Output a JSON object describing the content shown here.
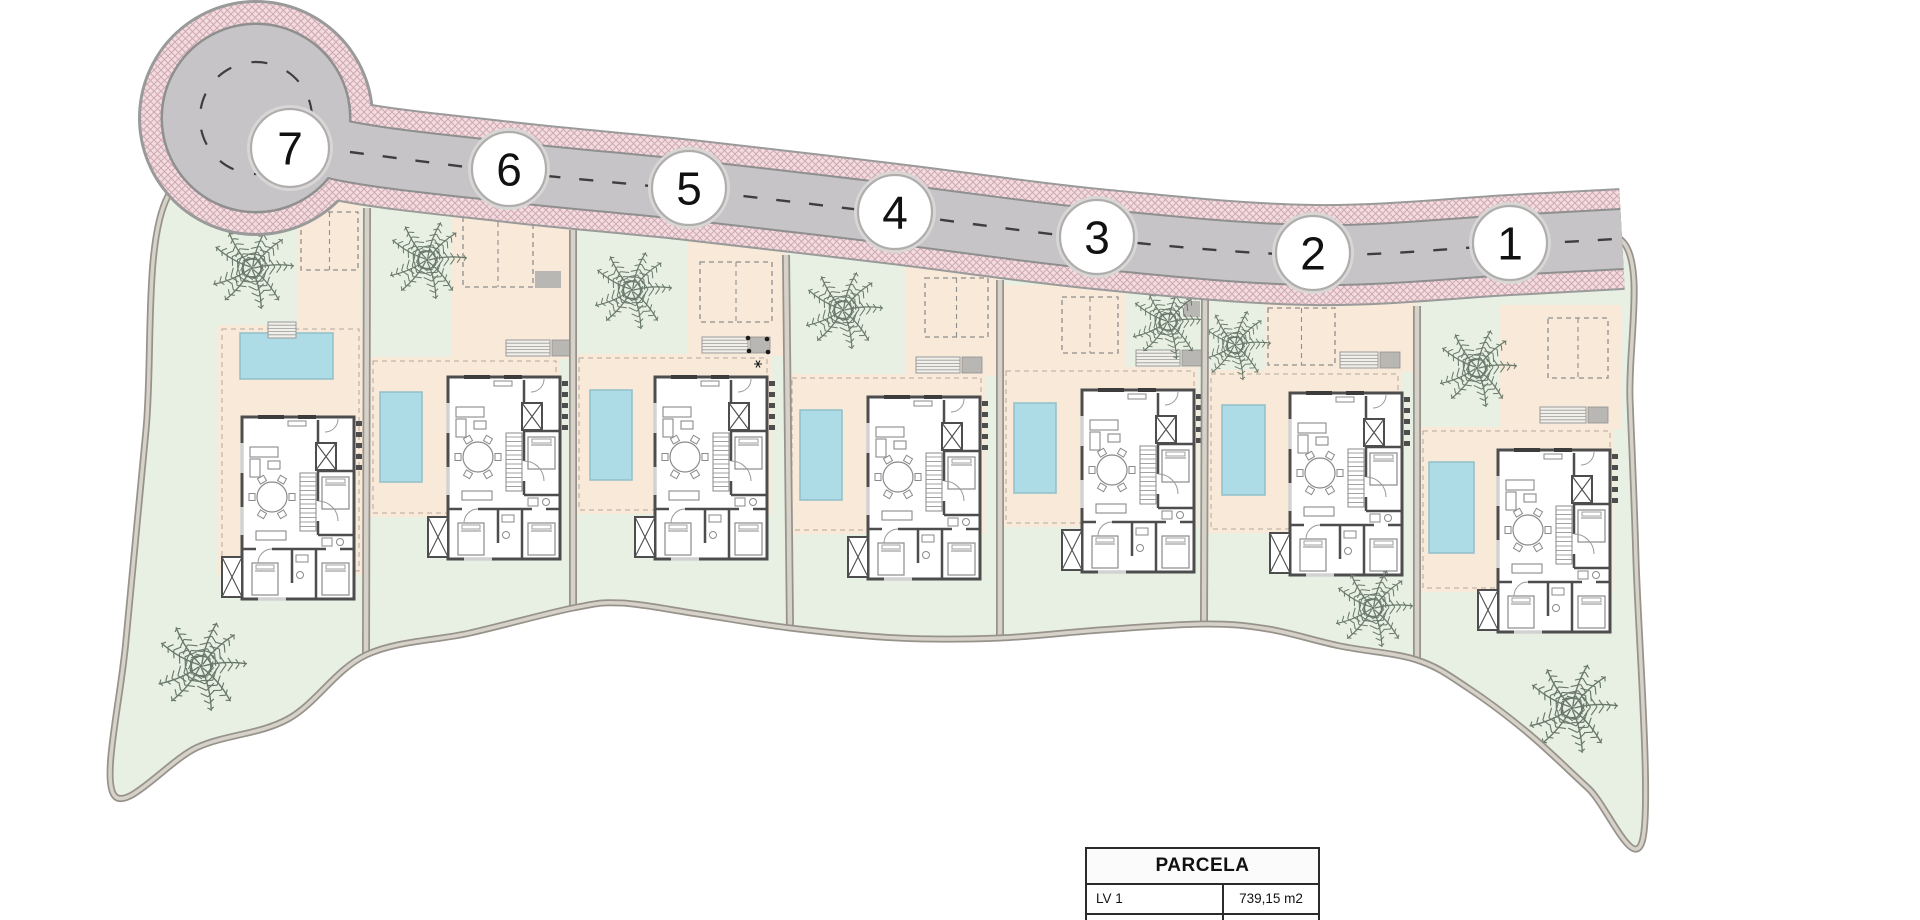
{
  "table": {
    "header": "PARCELA",
    "rows": [
      {
        "label": "LV 1",
        "value": "739,15 m2"
      }
    ]
  },
  "plan": {
    "colors": {
      "green": "#e7f0e2",
      "peach": "#f8e9d9",
      "pool": "#aedce6",
      "pool_edge": "#90bfca",
      "asphalt": "#c6c4c6",
      "road_edge": "#9a9a9a",
      "road_edge2": "#8f8f8f",
      "sidewalk_base": "#f2dce0",
      "sidewalk_line": "#d0a8b1",
      "wall_fill": "#d6d2c9",
      "wall_edge": "#97938b",
      "house_wall": "#4d4d4d",
      "furniture": "#8a8a8a",
      "window": "#d2d2d2",
      "step_fill": "#f1efe9",
      "kerb": "#b9b7b3",
      "center_dash": "#3e3e3e",
      "circle_stroke": "#b0adad",
      "number_text": "#111111",
      "palm": "#68786a",
      "terrace_dash": "#b3a89a",
      "parking_dash": "#8f8f8f"
    },
    "site": {
      "outline": [
        [
          168,
          196
        ],
        [
          290,
          158
        ],
        [
          509,
          176
        ],
        [
          689,
          194
        ],
        [
          895,
          218
        ],
        [
          1097,
          243
        ],
        [
          1313,
          259
        ],
        [
          1510,
          249
        ],
        [
          1624,
          243
        ],
        [
          1630,
          400
        ],
        [
          1636,
          560
        ],
        [
          1643,
          838
        ],
        [
          1588,
          788
        ],
        [
          1528,
          733
        ],
        [
          1468,
          688
        ],
        [
          1417,
          660
        ],
        [
          1340,
          646
        ],
        [
          1268,
          629
        ],
        [
          1204,
          624
        ],
        [
          1100,
          630
        ],
        [
          1000,
          638
        ],
        [
          898,
          638
        ],
        [
          790,
          628
        ],
        [
          698,
          614
        ],
        [
          622,
          603
        ],
        [
          573,
          608
        ],
        [
          470,
          633
        ],
        [
          366,
          655
        ],
        [
          288,
          719
        ],
        [
          198,
          747
        ],
        [
          114,
          795
        ],
        [
          126,
          640
        ],
        [
          146,
          430
        ]
      ]
    },
    "road": {
      "centerline": [
        [
          256,
          118
        ],
        [
          340,
          150
        ],
        [
          509,
          172
        ],
        [
          689,
          190
        ],
        [
          895,
          214
        ],
        [
          1097,
          239
        ],
        [
          1313,
          255
        ],
        [
          1510,
          245
        ],
        [
          1622,
          239
        ]
      ],
      "dashline": [
        [
          350,
          152
        ],
        [
          509,
          172
        ],
        [
          689,
          190
        ],
        [
          895,
          214
        ],
        [
          1097,
          239
        ],
        [
          1313,
          255
        ],
        [
          1510,
          245
        ],
        [
          1615,
          239
        ]
      ],
      "widths": {
        "edge": 102,
        "pink": 98,
        "edge2": 62,
        "asphalt": 58
      },
      "bulb": {
        "cx": 256,
        "cy": 118,
        "r_edge": 118,
        "r_pink": 115,
        "r_edge2": 95.5,
        "r_asphalt": 93,
        "r_dash": 56
      }
    },
    "walls": [
      [
        367,
        208,
        366,
        655
      ],
      [
        573,
        230,
        573,
        608
      ],
      [
        786,
        255,
        790,
        628
      ],
      [
        1000,
        280,
        1000,
        638
      ],
      [
        1205,
        298,
        1204,
        624
      ],
      [
        1417,
        306,
        1417,
        660
      ]
    ],
    "plots": [
      {
        "number": "7",
        "circle": [
          290,
          148,
          39
        ],
        "house": [
          242,
          417
        ],
        "pool": [
          240,
          333,
          93,
          46
        ],
        "terrace": [
          218,
          325,
          145,
          250
        ],
        "driveway": [
          297,
          192,
          64,
          135
        ],
        "parking": [
          301,
          212,
          57,
          58
        ],
        "steps": {
          "x": 268,
          "y": 322,
          "w": 28,
          "landing": false
        },
        "palms": [
          [
            252,
            268,
            1.05
          ],
          [
            201,
            666,
            1.15
          ]
        ]
      },
      {
        "number": "6",
        "circle": [
          509,
          169,
          37
        ],
        "house": [
          448,
          377
        ],
        "pool": [
          380,
          392,
          42,
          90
        ],
        "terrace": [
          369,
          357,
          191,
          160
        ],
        "driveway": [
          452,
          205,
          119,
          154
        ],
        "parking": [
          463,
          213,
          70,
          74
        ],
        "steps": {
          "x": 506,
          "y": 340,
          "w": 44,
          "landing": true
        },
        "kerb": [
          535,
          271,
          26,
          17
        ],
        "palms": [
          [
            427,
            260,
            1.0
          ]
        ]
      },
      {
        "number": "5",
        "circle": [
          689,
          188,
          37
        ],
        "house": [
          655,
          377
        ],
        "pool": [
          590,
          390,
          42,
          90
        ],
        "terrace": [
          575,
          354,
          196,
          160
        ],
        "driveway": [
          688,
          232,
          98,
          124
        ],
        "parking": [
          700,
          262,
          72,
          60
        ],
        "steps": {
          "x": 702,
          "y": 337,
          "w": 46,
          "landing": true
        },
        "bbq": {
          "dots": [
            [
              748,
              338
            ],
            [
              767,
              339
            ],
            [
              749,
              351
            ],
            [
              768,
              352
            ]
          ],
          "star": [
            758,
            364
          ]
        },
        "palms": [
          [
            632,
            290,
            1.0
          ]
        ]
      },
      {
        "number": "4",
        "circle": [
          895,
          212,
          37
        ],
        "house": [
          868,
          397
        ],
        "pool": [
          800,
          410,
          42,
          90
        ],
        "terrace": [
          788,
          374,
          197,
          160
        ],
        "driveway": [
          905,
          258,
          95,
          118
        ],
        "parking": [
          925,
          278,
          63,
          59
        ],
        "steps": {
          "x": 916,
          "y": 357,
          "w": 44,
          "landing": true
        },
        "palms": [
          [
            843,
            310,
            1.0
          ]
        ]
      },
      {
        "number": "3",
        "circle": [
          1097,
          237,
          37
        ],
        "house": [
          1082,
          390
        ],
        "pool": [
          1014,
          403,
          42,
          90
        ],
        "terrace": [
          1002,
          367,
          196,
          160
        ],
        "driveway": [
          1002,
          285,
          123,
          84
        ],
        "parking": [
          1062,
          297,
          56,
          56
        ],
        "steps": {
          "x": 1136,
          "y": 350,
          "w": 44,
          "landing": true
        },
        "kerb": [
          1184,
          301,
          16,
          16
        ],
        "palms": [
          [
            1168,
            322,
            0.95
          ]
        ]
      },
      {
        "number": "2",
        "circle": [
          1313,
          253,
          37
        ],
        "house": [
          1290,
          393
        ],
        "pool": [
          1222,
          405,
          43,
          90
        ],
        "terrace": [
          1207,
          370,
          195,
          163
        ],
        "driveway": [
          1265,
          298,
          152,
          74
        ],
        "parking": [
          1268,
          308,
          67,
          57
        ],
        "steps": {
          "x": 1340,
          "y": 352,
          "w": 38,
          "landing": true
        },
        "palms": [
          [
            1235,
            345,
            0.9
          ],
          [
            1373,
            608,
            1.0
          ]
        ]
      },
      {
        "number": "1",
        "circle": [
          1510,
          243,
          37
        ],
        "house": [
          1498,
          450
        ],
        "pool": [
          1429,
          462,
          45,
          91
        ],
        "terrace": [
          1419,
          427,
          195,
          165
        ],
        "driveway": [
          1500,
          305,
          122,
          124
        ],
        "parking": [
          1548,
          318,
          60,
          60
        ],
        "steps": {
          "x": 1540,
          "y": 407,
          "w": 46,
          "landing": true
        },
        "palms": [
          [
            1477,
            368,
            1.0
          ],
          [
            1572,
            708,
            1.15
          ]
        ]
      }
    ]
  }
}
